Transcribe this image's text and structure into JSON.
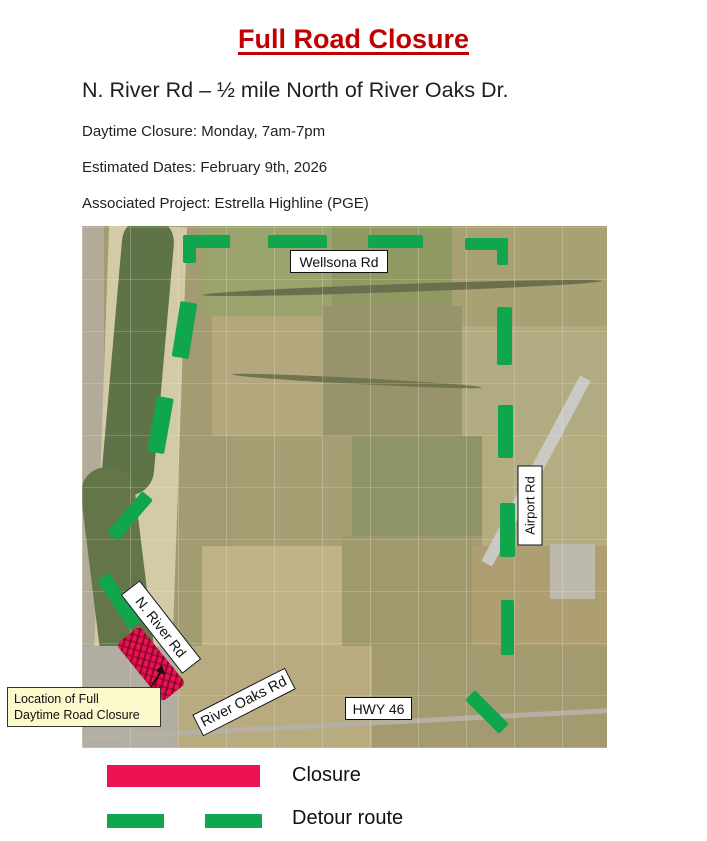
{
  "header": {
    "title": "Full Road Closure",
    "subtitle": "N. River Rd – ½ mile North of River Oaks Dr.",
    "details": [
      "Daytime Closure: Monday, 7am-7pm",
      "Estimated Dates: February 9th, 2026",
      "Associated Project: Estrella Highline (PGE)"
    ]
  },
  "map": {
    "labels": {
      "wellsona": "Wellsona Rd",
      "airport": "Airport Rd",
      "n_river": "N. River Rd",
      "river_oaks": "River Oaks Rd",
      "hwy46": "HWY 46"
    },
    "callout": {
      "line1": "Location of Full",
      "line2": "Daytime Road Closure"
    }
  },
  "legend": {
    "closure_label": "Closure",
    "detour_label": "Detour route"
  },
  "colors": {
    "title_red": "#C00000",
    "closure_red": "#EB1152",
    "detour_green": "#10A64E",
    "callout_bg": "#FCF9CC"
  }
}
